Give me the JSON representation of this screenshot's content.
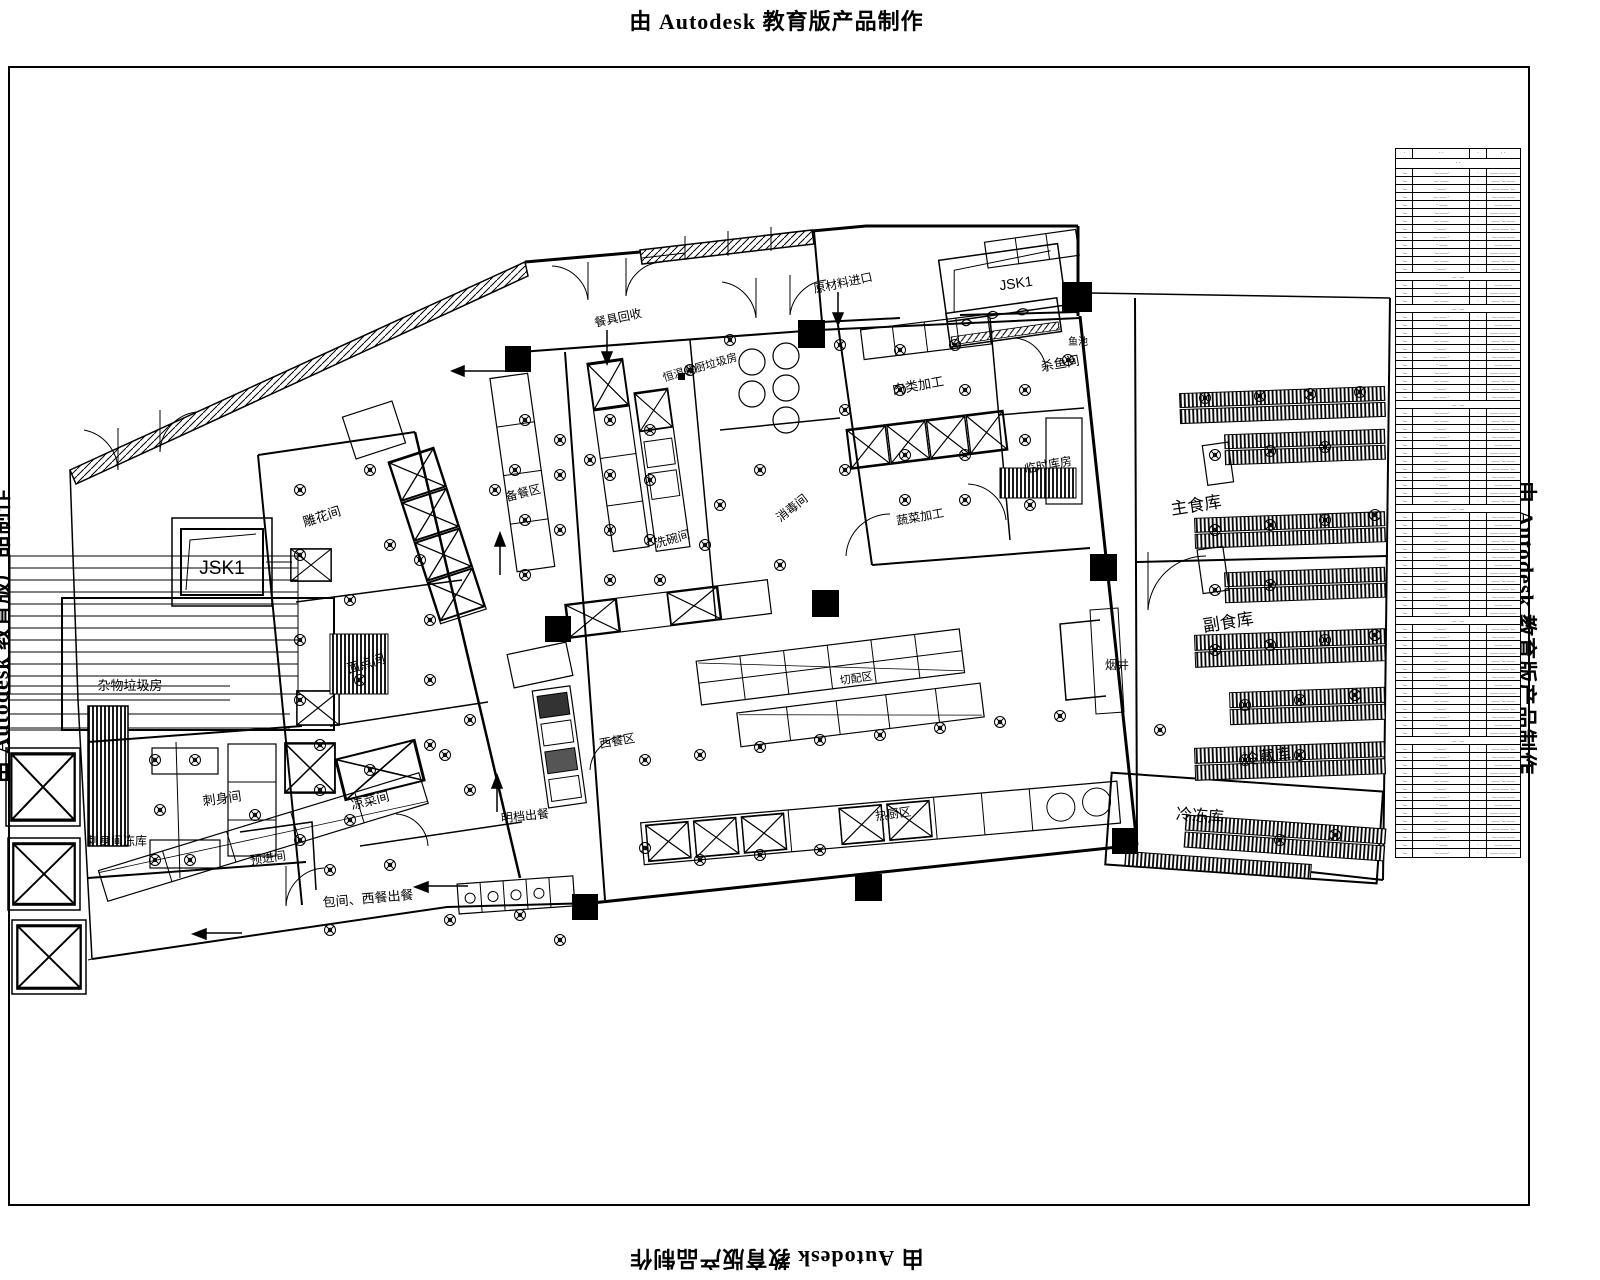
{
  "watermark": "由 Autodesk 教育版产品制作",
  "plan": {
    "labels": {
      "diaohua": "雕花间",
      "miandian": "面点间",
      "zawu": "杂物垃圾房",
      "cishen": "刺身间",
      "cishendk": "刺身间冻库",
      "yujin": "预进间",
      "liangcai": "凉菜间",
      "xiwan": "洗碗间",
      "beican": "备餐区",
      "xiaodu": "消毒间",
      "hengwen": "恒温餐厨垃圾房",
      "canju": "餐具回收",
      "yuanliao": "原材料进口",
      "roulei": "肉类加工",
      "shayu": "杀鱼间",
      "linshi": "临时库房",
      "shucai": "蔬菜加工",
      "yuchi": "鱼池",
      "jsk1": "JSK1",
      "zhushi": "主食库",
      "fushi": "副食库",
      "lengcang": "冷藏库",
      "lengdong": "冷冻库",
      "yanjing": "烟井",
      "qiepei": "切配区",
      "xican": "西餐区",
      "rechu": "热厨区",
      "mingdang": "明档出餐",
      "baojian": "包间、西餐出餐"
    }
  },
  "table": {
    "row_count": 86,
    "header": [
      "·",
      "· ·",
      "·",
      "· ·"
    ],
    "subheader": "· ·",
    "section_rows": [
      13,
      17,
      29,
      42,
      56,
      71
    ],
    "section_text": "— · —",
    "patterns": [
      [
        "·—",
        "·— ——·",
        "·",
        "—— —— ——"
      ],
      [
        "·—",
        "— ·——",
        "·",
        "—— ·— ——"
      ],
      [
        "·—",
        "·——·",
        "·",
        "—— —— ·—"
      ],
      [
        "·—",
        "— —— ·",
        "·",
        "·— —— ——"
      ],
      [
        "·—",
        "·· ——",
        "·",
        "—— ——"
      ]
    ]
  }
}
